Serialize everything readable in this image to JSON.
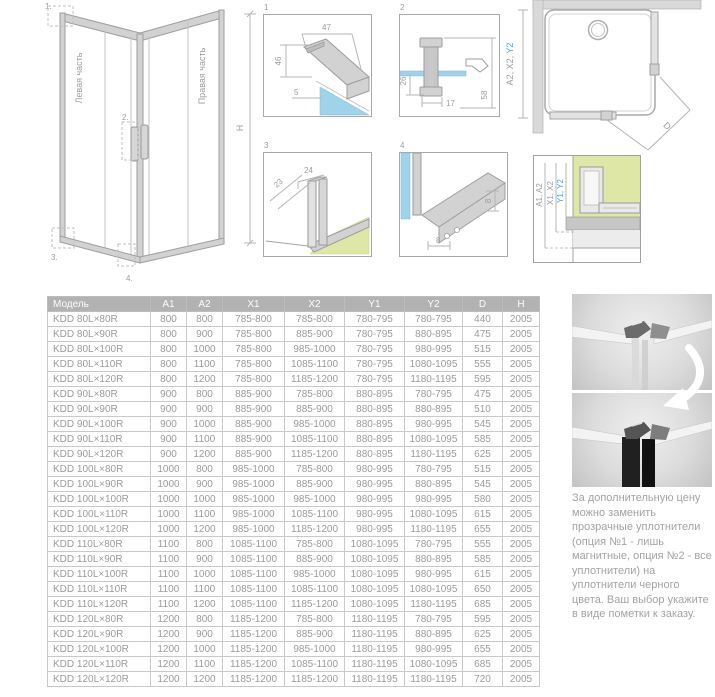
{
  "colors": {
    "accent_blue": "#3aa7da",
    "glass_blue": "#9fd3ea",
    "floor_green": "#dfe7a6",
    "header_gray": "#b2b2b2"
  },
  "iso": {
    "left_label": "Левая часть",
    "right_label": "Правая часть",
    "height_label": "H",
    "callouts": [
      "1.",
      "2.",
      "3.",
      "4."
    ]
  },
  "details": {
    "d1": {
      "num": "1",
      "dims": {
        "top": "47",
        "left": "46",
        "glass": "5"
      }
    },
    "d2": {
      "num": "2",
      "dims": {
        "left": "26",
        "bottom": "17",
        "right": "58"
      }
    },
    "d3": {
      "num": "3",
      "dims": {
        "diag": "23",
        "top": "24"
      }
    },
    "d4": {
      "num": "4",
      "dims": {
        "bottom": "8",
        "right": "8"
      }
    }
  },
  "plan": {
    "dim_gray": "A2, X2, ",
    "dim_blue": "Y2",
    "diag_label": "D"
  },
  "section": {
    "dim1": "A1, A2",
    "dim2": "X1, X2",
    "dim3": "Y1, Y2"
  },
  "table": {
    "headers": [
      "Модель",
      "A1",
      "A2",
      "X1",
      "X2",
      "Y1",
      "Y2",
      "D",
      "H"
    ],
    "rows": [
      [
        "KDD 80L×80R",
        "800",
        "800",
        "785-800",
        "785-800",
        "780-795",
        "780-795",
        "440",
        "2005"
      ],
      [
        "KDD 80L×90R",
        "800",
        "900",
        "785-800",
        "885-900",
        "780-795",
        "880-895",
        "475",
        "2005"
      ],
      [
        "KDD 80L×100R",
        "800",
        "1000",
        "785-800",
        "985-1000",
        "780-795",
        "980-995",
        "515",
        "2005"
      ],
      [
        "KDD 80L×110R",
        "800",
        "1100",
        "785-800",
        "1085-1100",
        "780-795",
        "1080-1095",
        "555",
        "2005"
      ],
      [
        "KDD 80L×120R",
        "800",
        "1200",
        "785-800",
        "1185-1200",
        "780-795",
        "1180-1195",
        "595",
        "2005"
      ],
      [
        "KDD 90L×80R",
        "900",
        "800",
        "885-900",
        "785-800",
        "880-895",
        "780-795",
        "475",
        "2005"
      ],
      [
        "KDD 90L×90R",
        "900",
        "900",
        "885-900",
        "885-900",
        "880-895",
        "880-895",
        "510",
        "2005"
      ],
      [
        "KDD 90L×100R",
        "900",
        "1000",
        "885-900",
        "985-1000",
        "880-895",
        "980-995",
        "545",
        "2005"
      ],
      [
        "KDD 90L×110R",
        "900",
        "1100",
        "885-900",
        "1085-1100",
        "880-895",
        "1080-1095",
        "585",
        "2005"
      ],
      [
        "KDD 90L×120R",
        "900",
        "1200",
        "885-900",
        "1185-1200",
        "880-895",
        "1180-1195",
        "625",
        "2005"
      ],
      [
        "KDD 100L×80R",
        "1000",
        "800",
        "985-1000",
        "785-800",
        "980-995",
        "780-795",
        "515",
        "2005"
      ],
      [
        "KDD 100L×90R",
        "1000",
        "900",
        "985-1000",
        "885-900",
        "980-995",
        "880-895",
        "545",
        "2005"
      ],
      [
        "KDD 100L×100R",
        "1000",
        "1000",
        "985-1000",
        "985-1000",
        "980-995",
        "980-995",
        "580",
        "2005"
      ],
      [
        "KDD 100L×110R",
        "1000",
        "1100",
        "985-1000",
        "1085-1100",
        "980-995",
        "1080-1095",
        "615",
        "2005"
      ],
      [
        "KDD 100L×120R",
        "1000",
        "1200",
        "985-1000",
        "1185-1200",
        "980-995",
        "1180-1195",
        "655",
        "2005"
      ],
      [
        "KDD 110L×80R",
        "1100",
        "800",
        "1085-1100",
        "785-800",
        "1080-1095",
        "780-795",
        "555",
        "2005"
      ],
      [
        "KDD 110L×90R",
        "1100",
        "900",
        "1085-1100",
        "885-900",
        "1080-1095",
        "880-895",
        "585",
        "2005"
      ],
      [
        "KDD 110L×100R",
        "1100",
        "1000",
        "1085-1100",
        "985-1000",
        "1080-1095",
        "980-995",
        "615",
        "2005"
      ],
      [
        "KDD 110L×110R",
        "1100",
        "1100",
        "1085-1100",
        "1085-1100",
        "1080-1095",
        "1080-1095",
        "650",
        "2005"
      ],
      [
        "KDD 110L×120R",
        "1100",
        "1200",
        "1085-1100",
        "1185-1200",
        "1080-1095",
        "1180-1195",
        "685",
        "2005"
      ],
      [
        "KDD 120L×80R",
        "1200",
        "800",
        "1185-1200",
        "785-800",
        "1180-1195",
        "780-795",
        "595",
        "2005"
      ],
      [
        "KDD 120L×90R",
        "1200",
        "900",
        "1185-1200",
        "885-900",
        "1180-1195",
        "880-895",
        "625",
        "2005"
      ],
      [
        "KDD 120L×100R",
        "1200",
        "1000",
        "1185-1200",
        "985-1000",
        "1180-1195",
        "980-995",
        "655",
        "2005"
      ],
      [
        "KDD 120L×110R",
        "1200",
        "1100",
        "1185-1200",
        "1085-1100",
        "1180-1195",
        "1080-1095",
        "685",
        "2005"
      ],
      [
        "KDD 120L×120R",
        "1200",
        "1200",
        "1185-1200",
        "1185-1200",
        "1180-1195",
        "1180-1195",
        "720",
        "2005"
      ]
    ]
  },
  "note": "За дополнительную цену можно заменить прозрачные уплотнители (опция №1 - лишь магнитные, опция №2 - все уплотнители)  на уплотнители черного цвета. Ваш выбор укажите в виде пометки к заказу."
}
